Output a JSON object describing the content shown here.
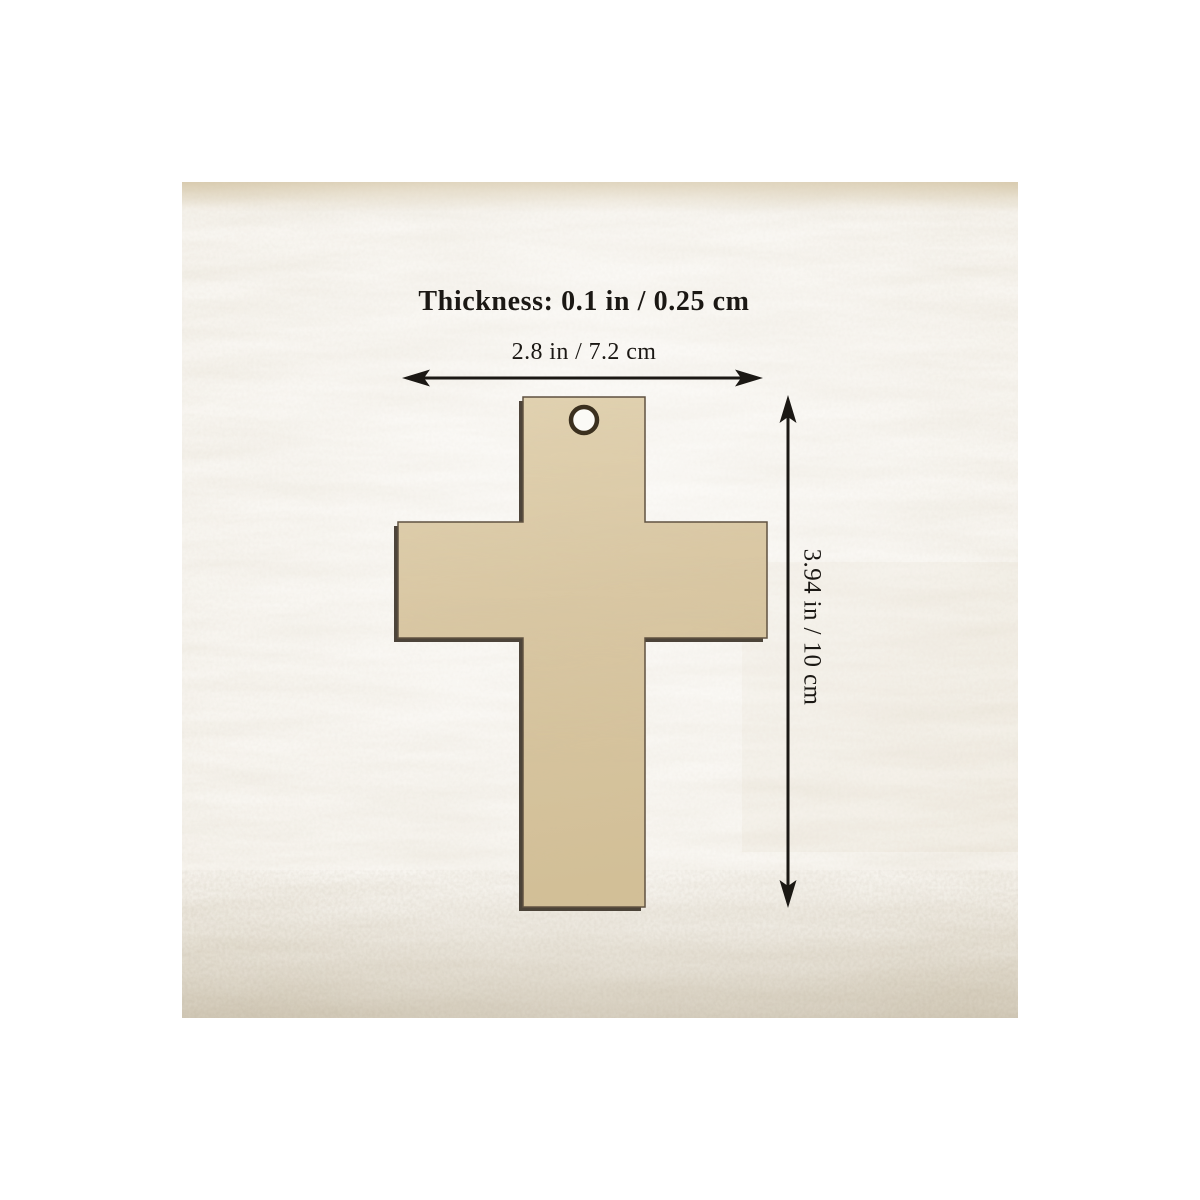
{
  "page": {
    "background": "#ffffff",
    "description": "Product dimension diagram of an unfinished wooden cross cutout on whitewashed wood background"
  },
  "photo": {
    "name": "whitewashed-wood-product-photo",
    "base_color": "#f7f4ee",
    "streak_color": "#b9a888"
  },
  "product": {
    "name": "Unfinished wooden cross blank with hanging hole",
    "wood_fill_light": "#e2d3b2",
    "wood_fill_mid": "#d9c7a3",
    "wood_fill_dark": "#d2bf97",
    "edge_shadow": "#3a3126",
    "outline": "#5f5140",
    "hole_ring": "#3b301f",
    "hole_fill": "#fbfaf6"
  },
  "annotations": {
    "color": "#1b1814",
    "thickness_label": "Thickness: 0.1 in / 0.25 cm",
    "width_label": "2.8 in / 7.2 cm",
    "height_label": "3.94 in / 10 cm"
  }
}
